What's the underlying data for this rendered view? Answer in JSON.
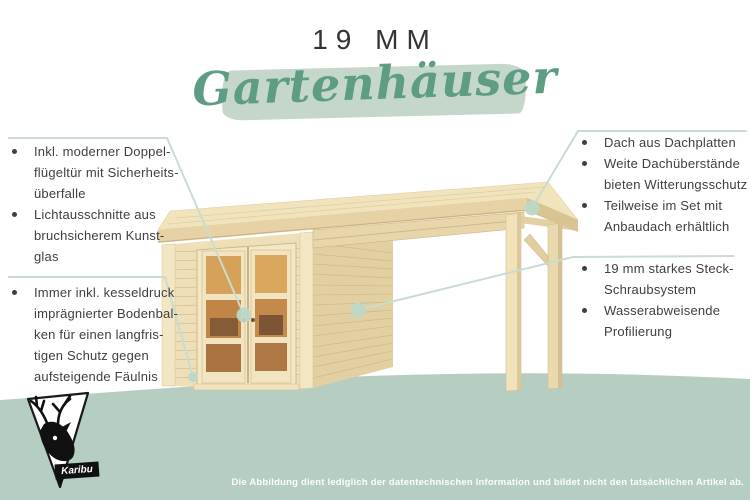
{
  "header": {
    "kicker": "19 MM",
    "title": "Gartenhäuser"
  },
  "callouts": {
    "left_top": {
      "items": [
        "Inkl. moderner Doppel-\nflügeltür mit Sicherheits-\nüberfalle",
        "Lichtausschnitte aus\nbruchsicherem Kunst-\nglas"
      ]
    },
    "left_bottom": {
      "items": [
        "Immer inkl. kesseldruck\nimprägnierter Bodenbal-\nken für einen langfris-\ntigen Schutz gegen\naufsteigende Fäulnis"
      ]
    },
    "right_top": {
      "items": [
        "Dach aus Dachplatten",
        "Weite Dachüberstände\nbieten Witterungsschutz",
        "Teilweise im Set mit\nAnbaudach erhältlich"
      ]
    },
    "right_bottom": {
      "items": [
        "19 mm starkes Steck-\nSchraubsystem",
        "Wasserabweisende\nProfilierung"
      ]
    }
  },
  "illustration": {
    "subject": "Gartenhaus mit Anbaudach"
  },
  "brand": {
    "logo_text": "Karibu"
  },
  "footer": {
    "disclaimer": "Die Abbildung dient lediglich der datentechnischen Information und bildet nicht den tatsächlichen Artikel ab."
  },
  "colors": {
    "accent_green": "#5e9d83",
    "brush_green": "#c5d7ca",
    "ground_band_green": "#b5cec1",
    "callout_line_green": "#c9dccf",
    "text_dark": "#3f3f3f",
    "wood_light": "#f1e3bc",
    "wood_mid": "#e6d2a4",
    "wood_dark": "#d9c392"
  }
}
